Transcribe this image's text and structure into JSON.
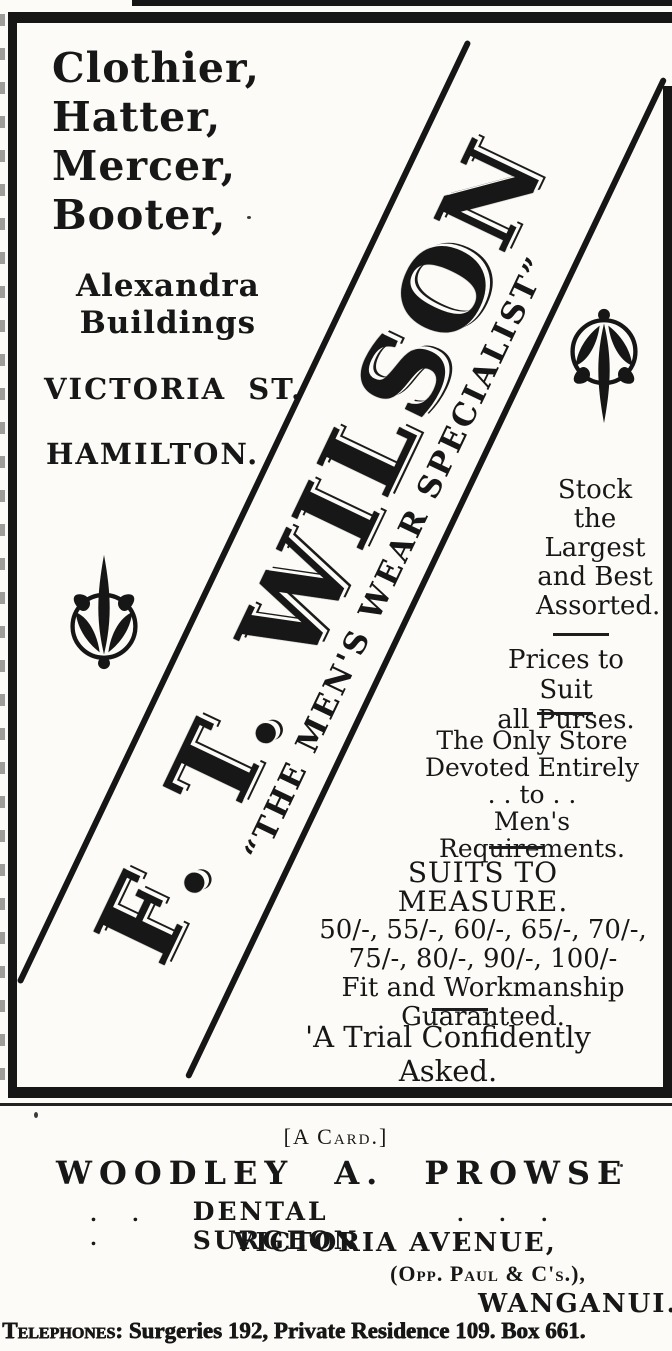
{
  "page": {
    "paper_color": "#fcfbf7",
    "ink_color": "#171717"
  },
  "wilson_ad": {
    "services": [
      "Clothier,",
      "Hatter,",
      "Mercer,",
      "Booter,"
    ],
    "building": [
      "Alexandra",
      "Buildings"
    ],
    "street": "VICTORIA ST.",
    "city": "HAMILTON.",
    "name": "F. T. WILSON",
    "slogan": "“THE MEN'S WEAR SPECIALIST”",
    "stock": [
      "Stock",
      "the",
      "Largest",
      "and Best",
      "Assorted."
    ],
    "prices": [
      "Prices to Suit",
      "all Purses."
    ],
    "exclusive": [
      "The Only Store",
      "Devoted Entirely",
      ". . to . .",
      "Men's Requirements."
    ],
    "suits_heading": "SUITS TO MEASURE.",
    "suits_prices": [
      "50/-, 55/-, 60/-, 65/-, 70/-,",
      "75/-, 80/-, 90/-, 100/-"
    ],
    "suits_guarantee": [
      "Fit and Workmanship",
      "Guaranteed."
    ],
    "trial": "'A Trial Confidently Asked."
  },
  "prowse_card": {
    "tag": "[A Card.]",
    "name": "WOODLEY A. PROWSE",
    "left_dots": ". . .",
    "profession": "DENTAL SURGEON",
    "right_dots": ". . . .",
    "address": "VICTORIA AVENUE,",
    "landmark": "(Opp. Paul & C's.),",
    "town": "WANGANUI.",
    "phones_label": "Telephones:",
    "phones_rest": " Surgeries 192, Private Residence 109. Box 661."
  },
  "icons": {
    "ornament": "floral-printer-ornament"
  }
}
